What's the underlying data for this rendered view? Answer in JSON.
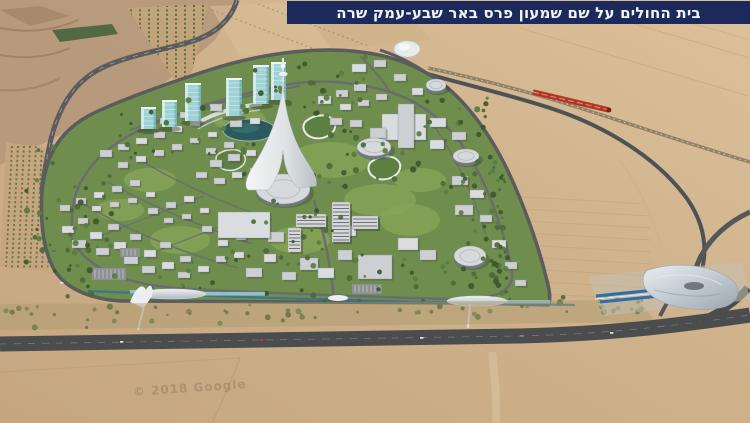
{
  "banner": {
    "text": "בית החולים על שם שמעון פרס באר שבע-עמק שרה"
  },
  "watermark": {
    "text": "© 2018 Google"
  },
  "palette": {
    "banner_bg": "#1b2a5a",
    "banner_text": "#f2f4f8",
    "sand": "#cfb28b",
    "sand_light": "#dcc19b",
    "sand_dark": "#b2946f",
    "terrain_rough": "#b5977a",
    "campus_green": "#6f8e4d",
    "lawn": "#86a558",
    "tree_dark": "#3c572e",
    "tree_mid": "#4c6a39",
    "tree_light": "#587c41",
    "road": "#55585a",
    "building": "#ccd0d3",
    "building_shadow": "#8e959b",
    "glass_teal": "#9ed2d4",
    "lake": "#2a5a5e",
    "spire_white": "#eceff1",
    "train_red": "#b23524",
    "transit_blue": "#2f7396",
    "station_roof": "#c6cdd3"
  }
}
